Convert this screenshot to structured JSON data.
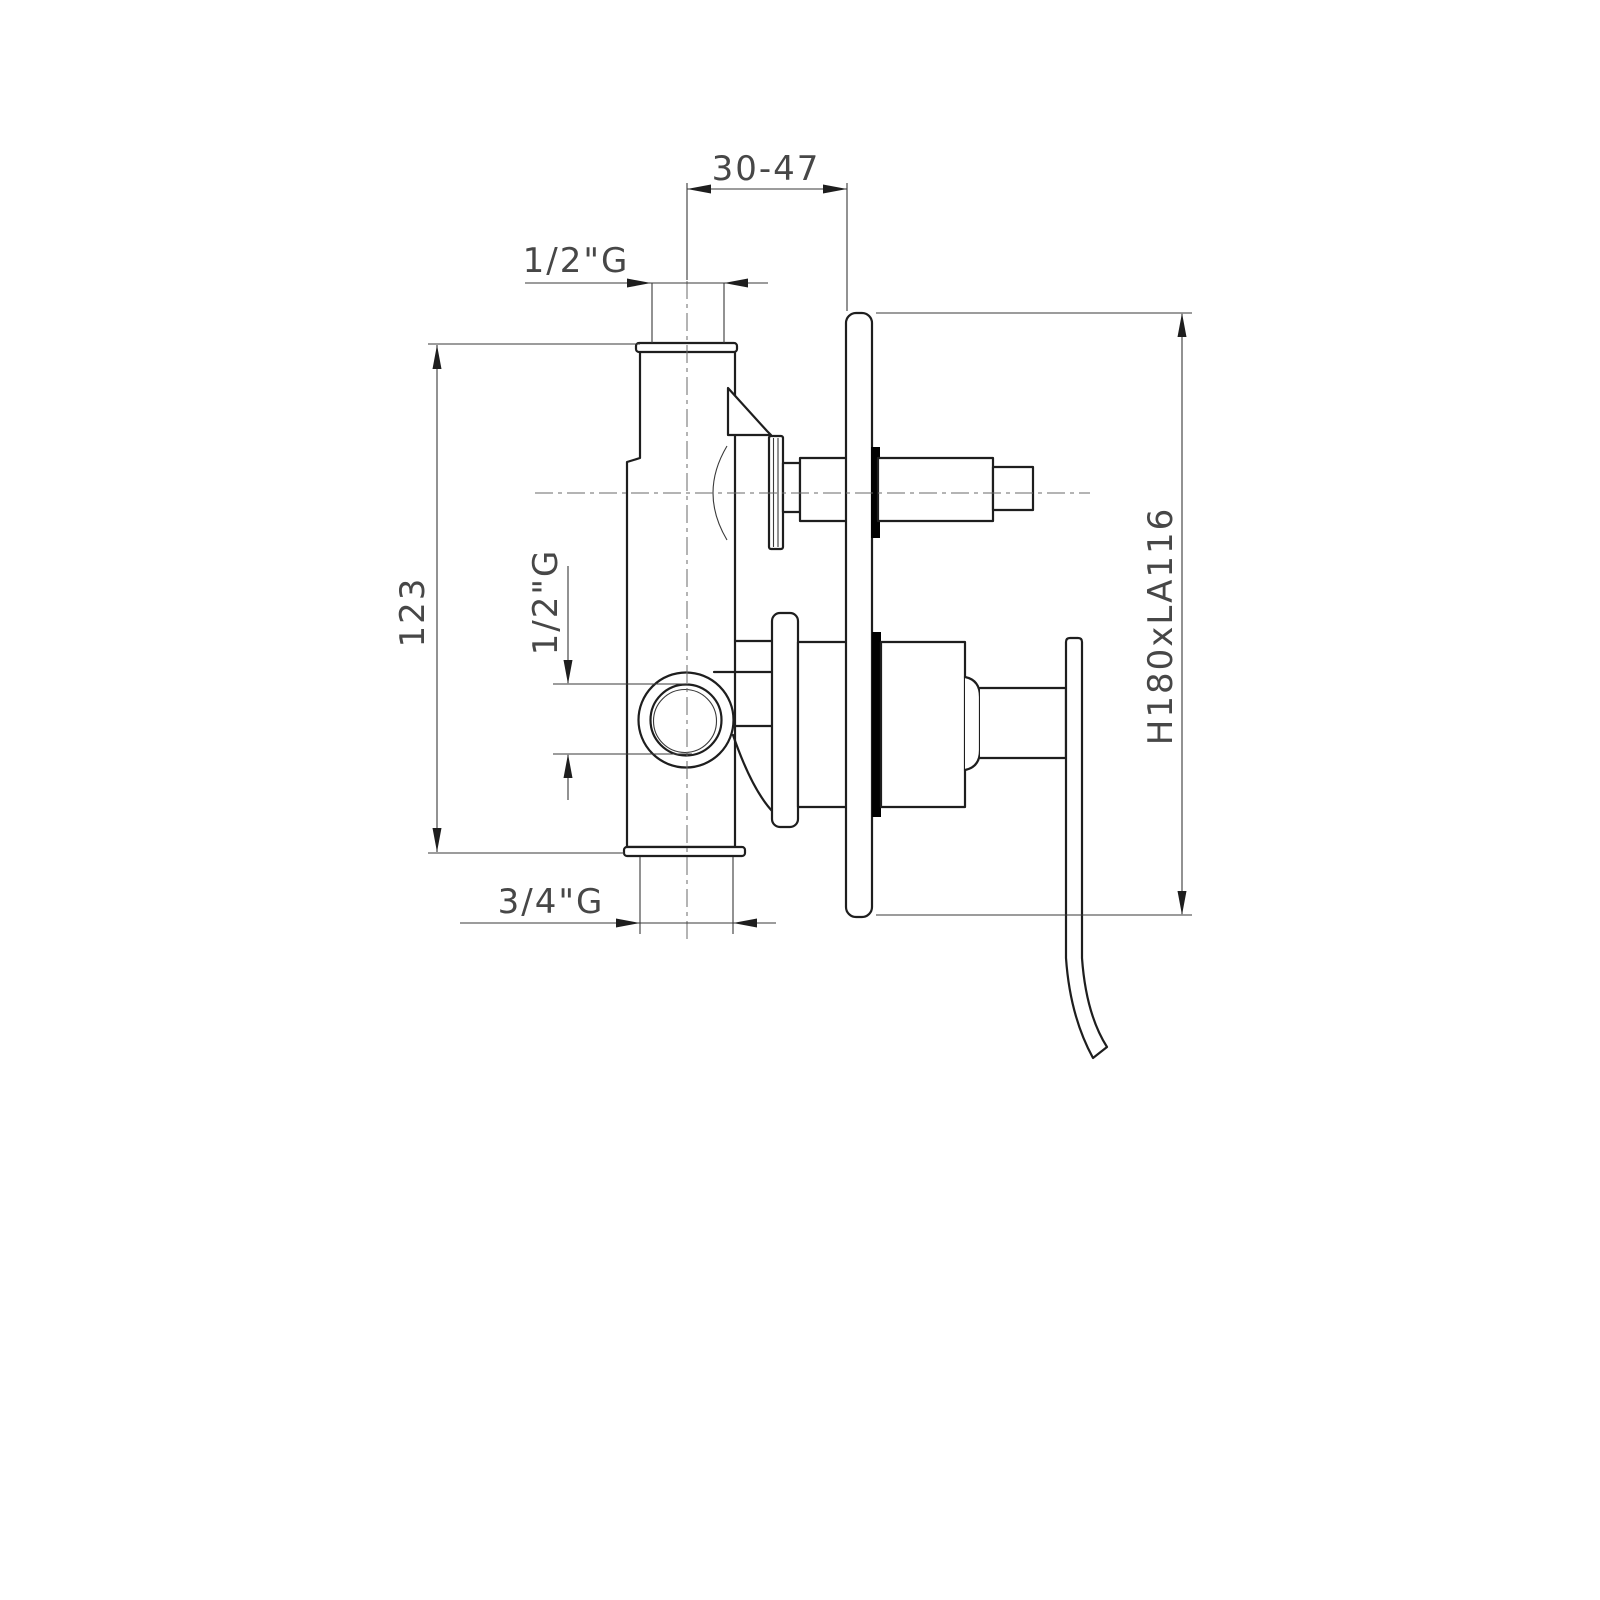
{
  "drawing": {
    "type": "technical-dimension-drawing",
    "subject": "concealed-shower-mixer-valve-side-view",
    "labels": {
      "top_offset": "30-47",
      "top_inlet": "1/2\"G",
      "body_height": "123",
      "side_port": "1/2\"G",
      "bottom_outlet": "3/4\"G",
      "plate_size": "H180xLA116"
    },
    "colors": {
      "outline": "#1e1e1e",
      "dimension": "#3a3a3a",
      "text": "#474747",
      "seal": "#000000",
      "background": "#ffffff"
    }
  }
}
